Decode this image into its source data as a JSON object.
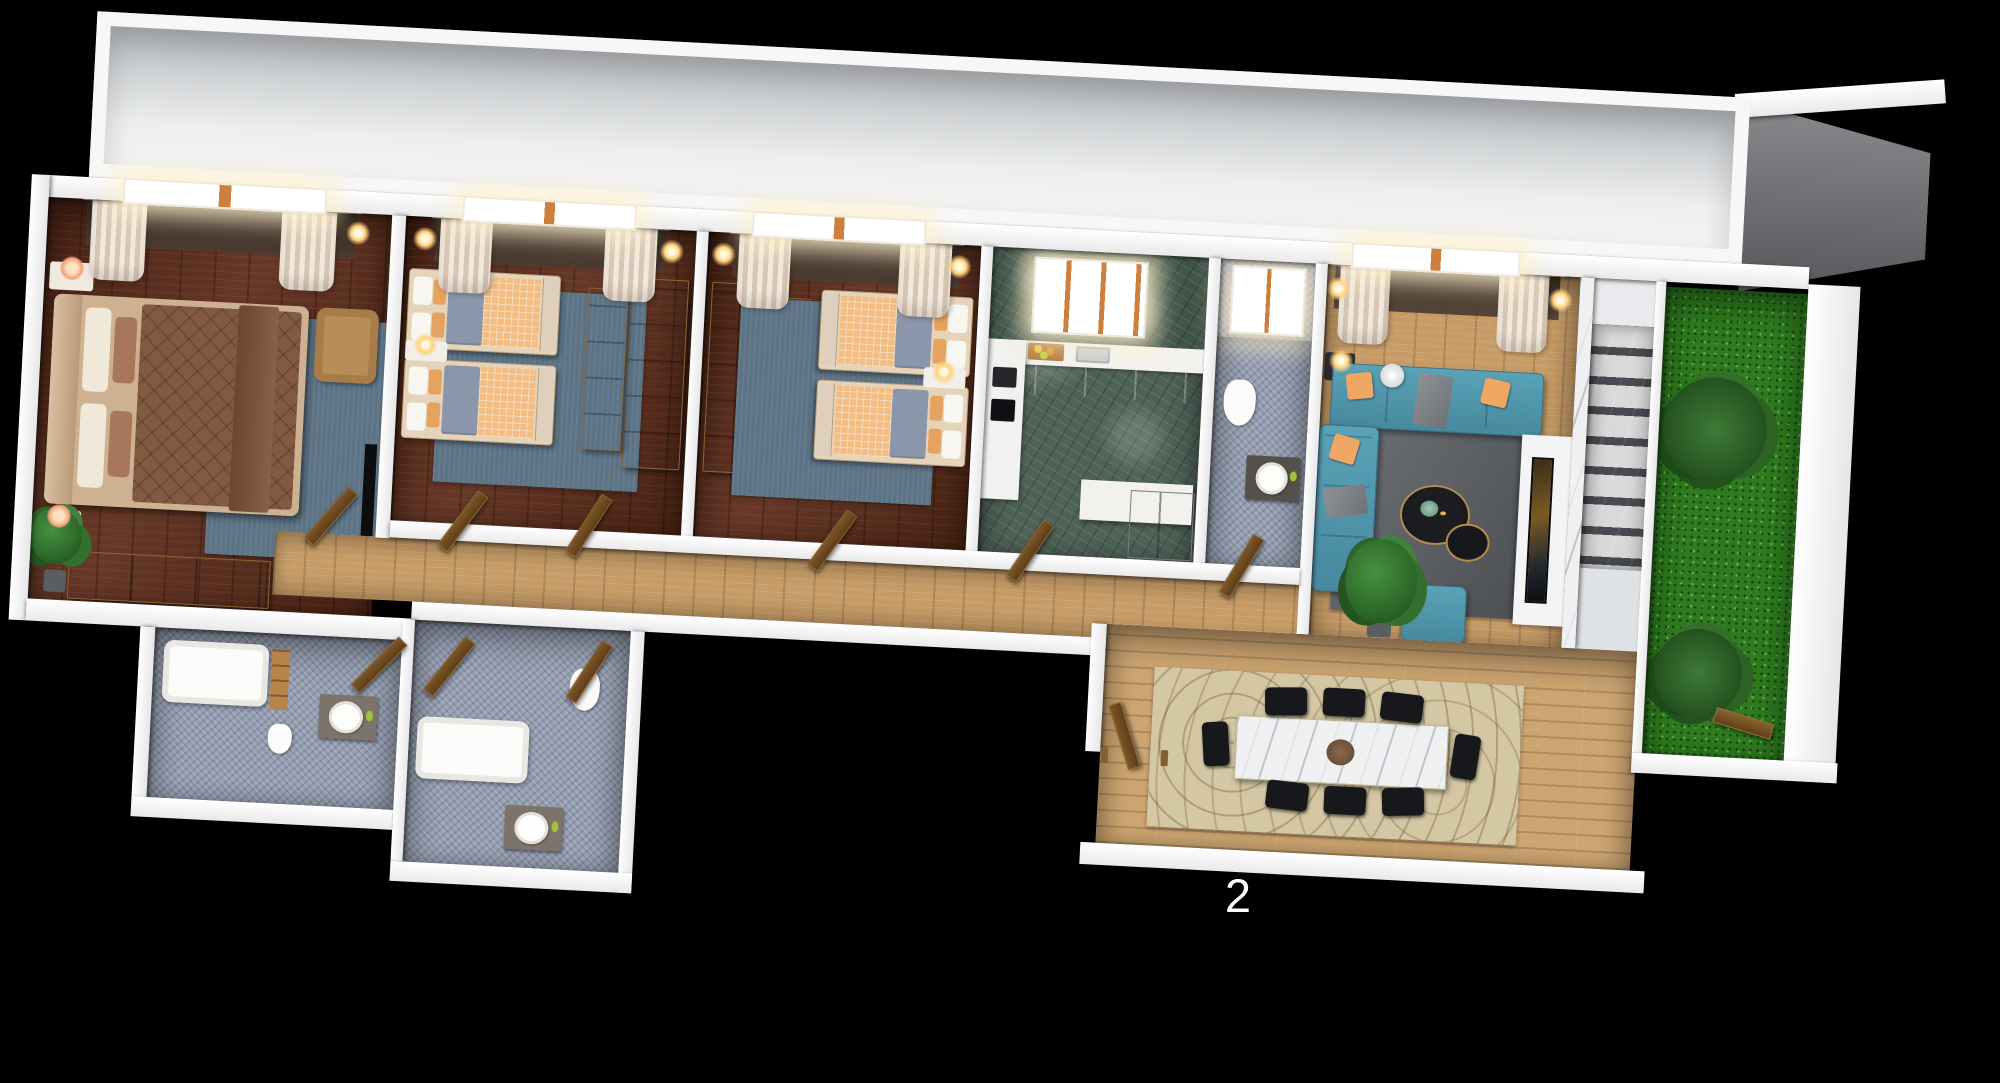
{
  "page": {
    "background": "#000000",
    "floor_label": "2"
  },
  "palette": {
    "wall": "#f5f5f6",
    "terrace": "#d6d8da",
    "terrace_shadow": "#707376",
    "darkwood": "#5d2c1a",
    "oak": "#c79c66",
    "deck": "#cda571",
    "green_marble": "#4f6258",
    "green_marble_wall": "#3f5348",
    "mosaic": "#939cb0",
    "mosaic_wall": "#8089a0",
    "grass": "#2e7c1f",
    "white_marble": "#eef0f2",
    "sofa_teal": "#4e96ac",
    "accent_orange": "#eda766",
    "rug_blue": "#5c7385",
    "rug_gray": "#606468",
    "rug_beige": "#d3c7a4",
    "bed_frame_tan": "#c8a988",
    "duvet_brown": "#815a41",
    "wardrobe_oak": "#c89468",
    "door_wood": "#6e4a22",
    "chair_black": "#17181b",
    "window_glow": "#fff1cd",
    "curtain_cream": "#e9dccd"
  }
}
